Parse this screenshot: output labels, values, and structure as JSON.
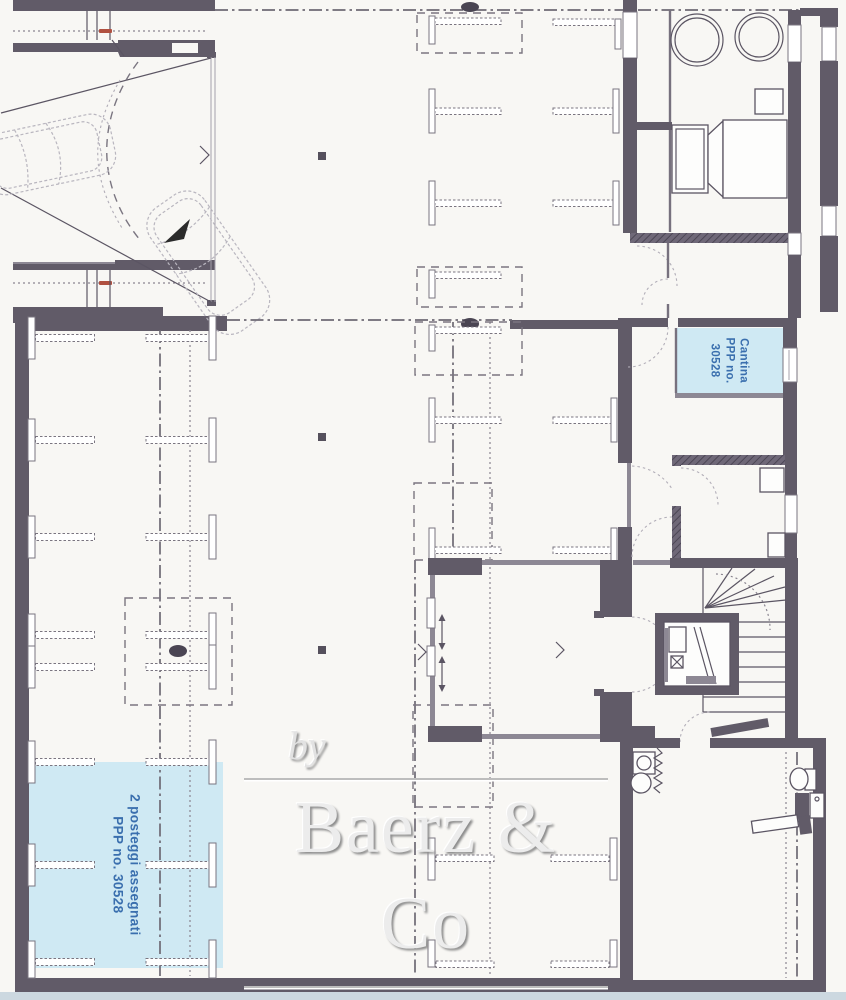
{
  "palette": {
    "wall": "#615b68",
    "paper": "#f8f7f4",
    "highlight_fill": "#cfe9f3",
    "highlight_text": "#3a6fae",
    "watermark_gray": "#8d8d8d",
    "scan_edge_blue": "#ccd8e0",
    "red_tick": "#b05040"
  },
  "labels": {
    "cantina": {
      "lines": [
        "Cantina",
        "PPP no.",
        "30528"
      ]
    },
    "parking": {
      "lines": [
        "2 posteggi assegnati",
        "PPP no. 30528"
      ]
    }
  },
  "watermark": {
    "prefix": "by",
    "brand": "Baerz & Co",
    "tagline": "LUXURY HOMES"
  }
}
